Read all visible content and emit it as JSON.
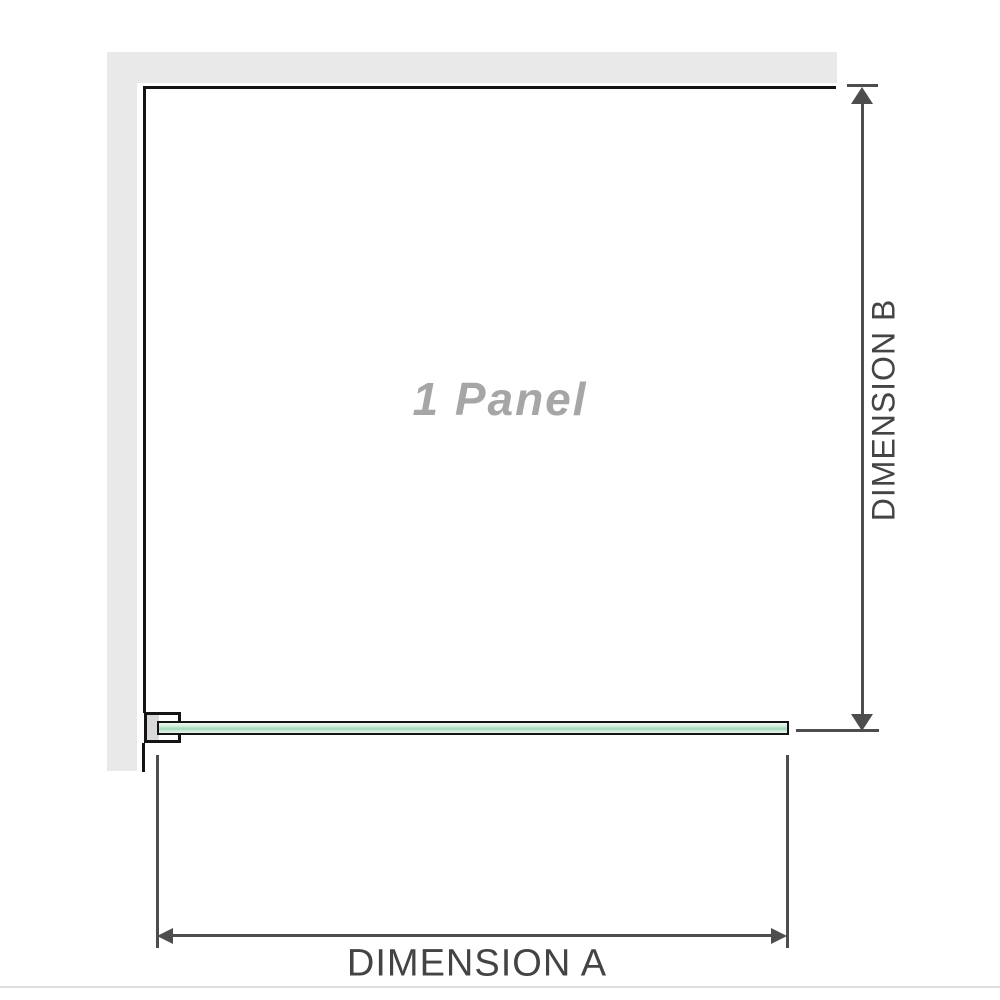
{
  "figure": {
    "panel_label": "1 Panel",
    "dimension_a": {
      "label": "DIMENSION A"
    },
    "dimension_b": {
      "label": "DIMENSION B"
    },
    "colors": {
      "wall_gray": "#e9e9e9",
      "outline_black": "#141414",
      "dimension_gray": "#4d4d4d",
      "glass_green_light": "#d5eedf",
      "glass_green_mid": "#a8dcbd",
      "panel_label_gray": "#a6a6a6",
      "divider_gray": "#dedede"
    }
  }
}
